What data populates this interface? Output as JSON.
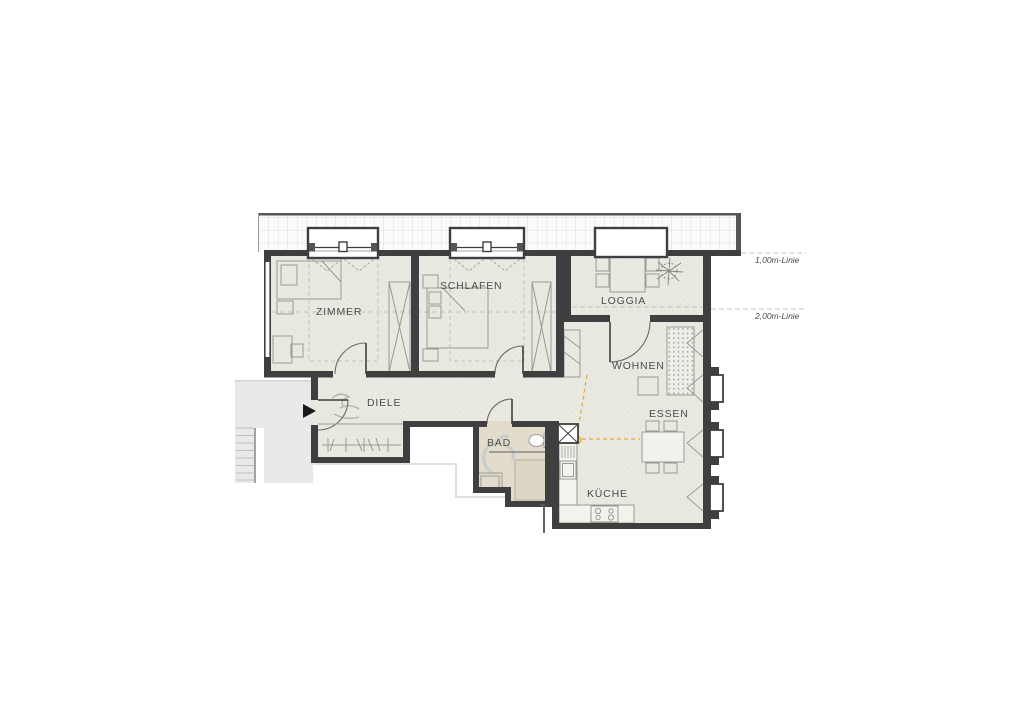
{
  "plan": {
    "title": "apartment-floor-plan",
    "rooms": {
      "zimmer": {
        "label": "ZIMMER"
      },
      "schlafen": {
        "label": "SCHLAFEN"
      },
      "loggia": {
        "label": "LOGGIA"
      },
      "wohnen": {
        "label": "WOHNEN"
      },
      "essen": {
        "label": "ESSEN"
      },
      "kueche": {
        "label": "KÜCHE"
      },
      "bad": {
        "label": "BAD"
      },
      "diele": {
        "label": "DIELE"
      }
    },
    "height_lines": [
      {
        "label": "1,00m-Linie"
      },
      {
        "label": "2,00m-Linie"
      }
    ],
    "colors": {
      "floor": "#e9e8e1",
      "bath_floor": "#e3dccd",
      "stair_area": "#e9e9e9",
      "wall": "#3f3f3f",
      "furniture_line": "#9a9a94",
      "dashed_line": "#c3c3bd",
      "accent_orange": "#e6a93c",
      "ghost_figure": "#b7c3cb"
    }
  }
}
